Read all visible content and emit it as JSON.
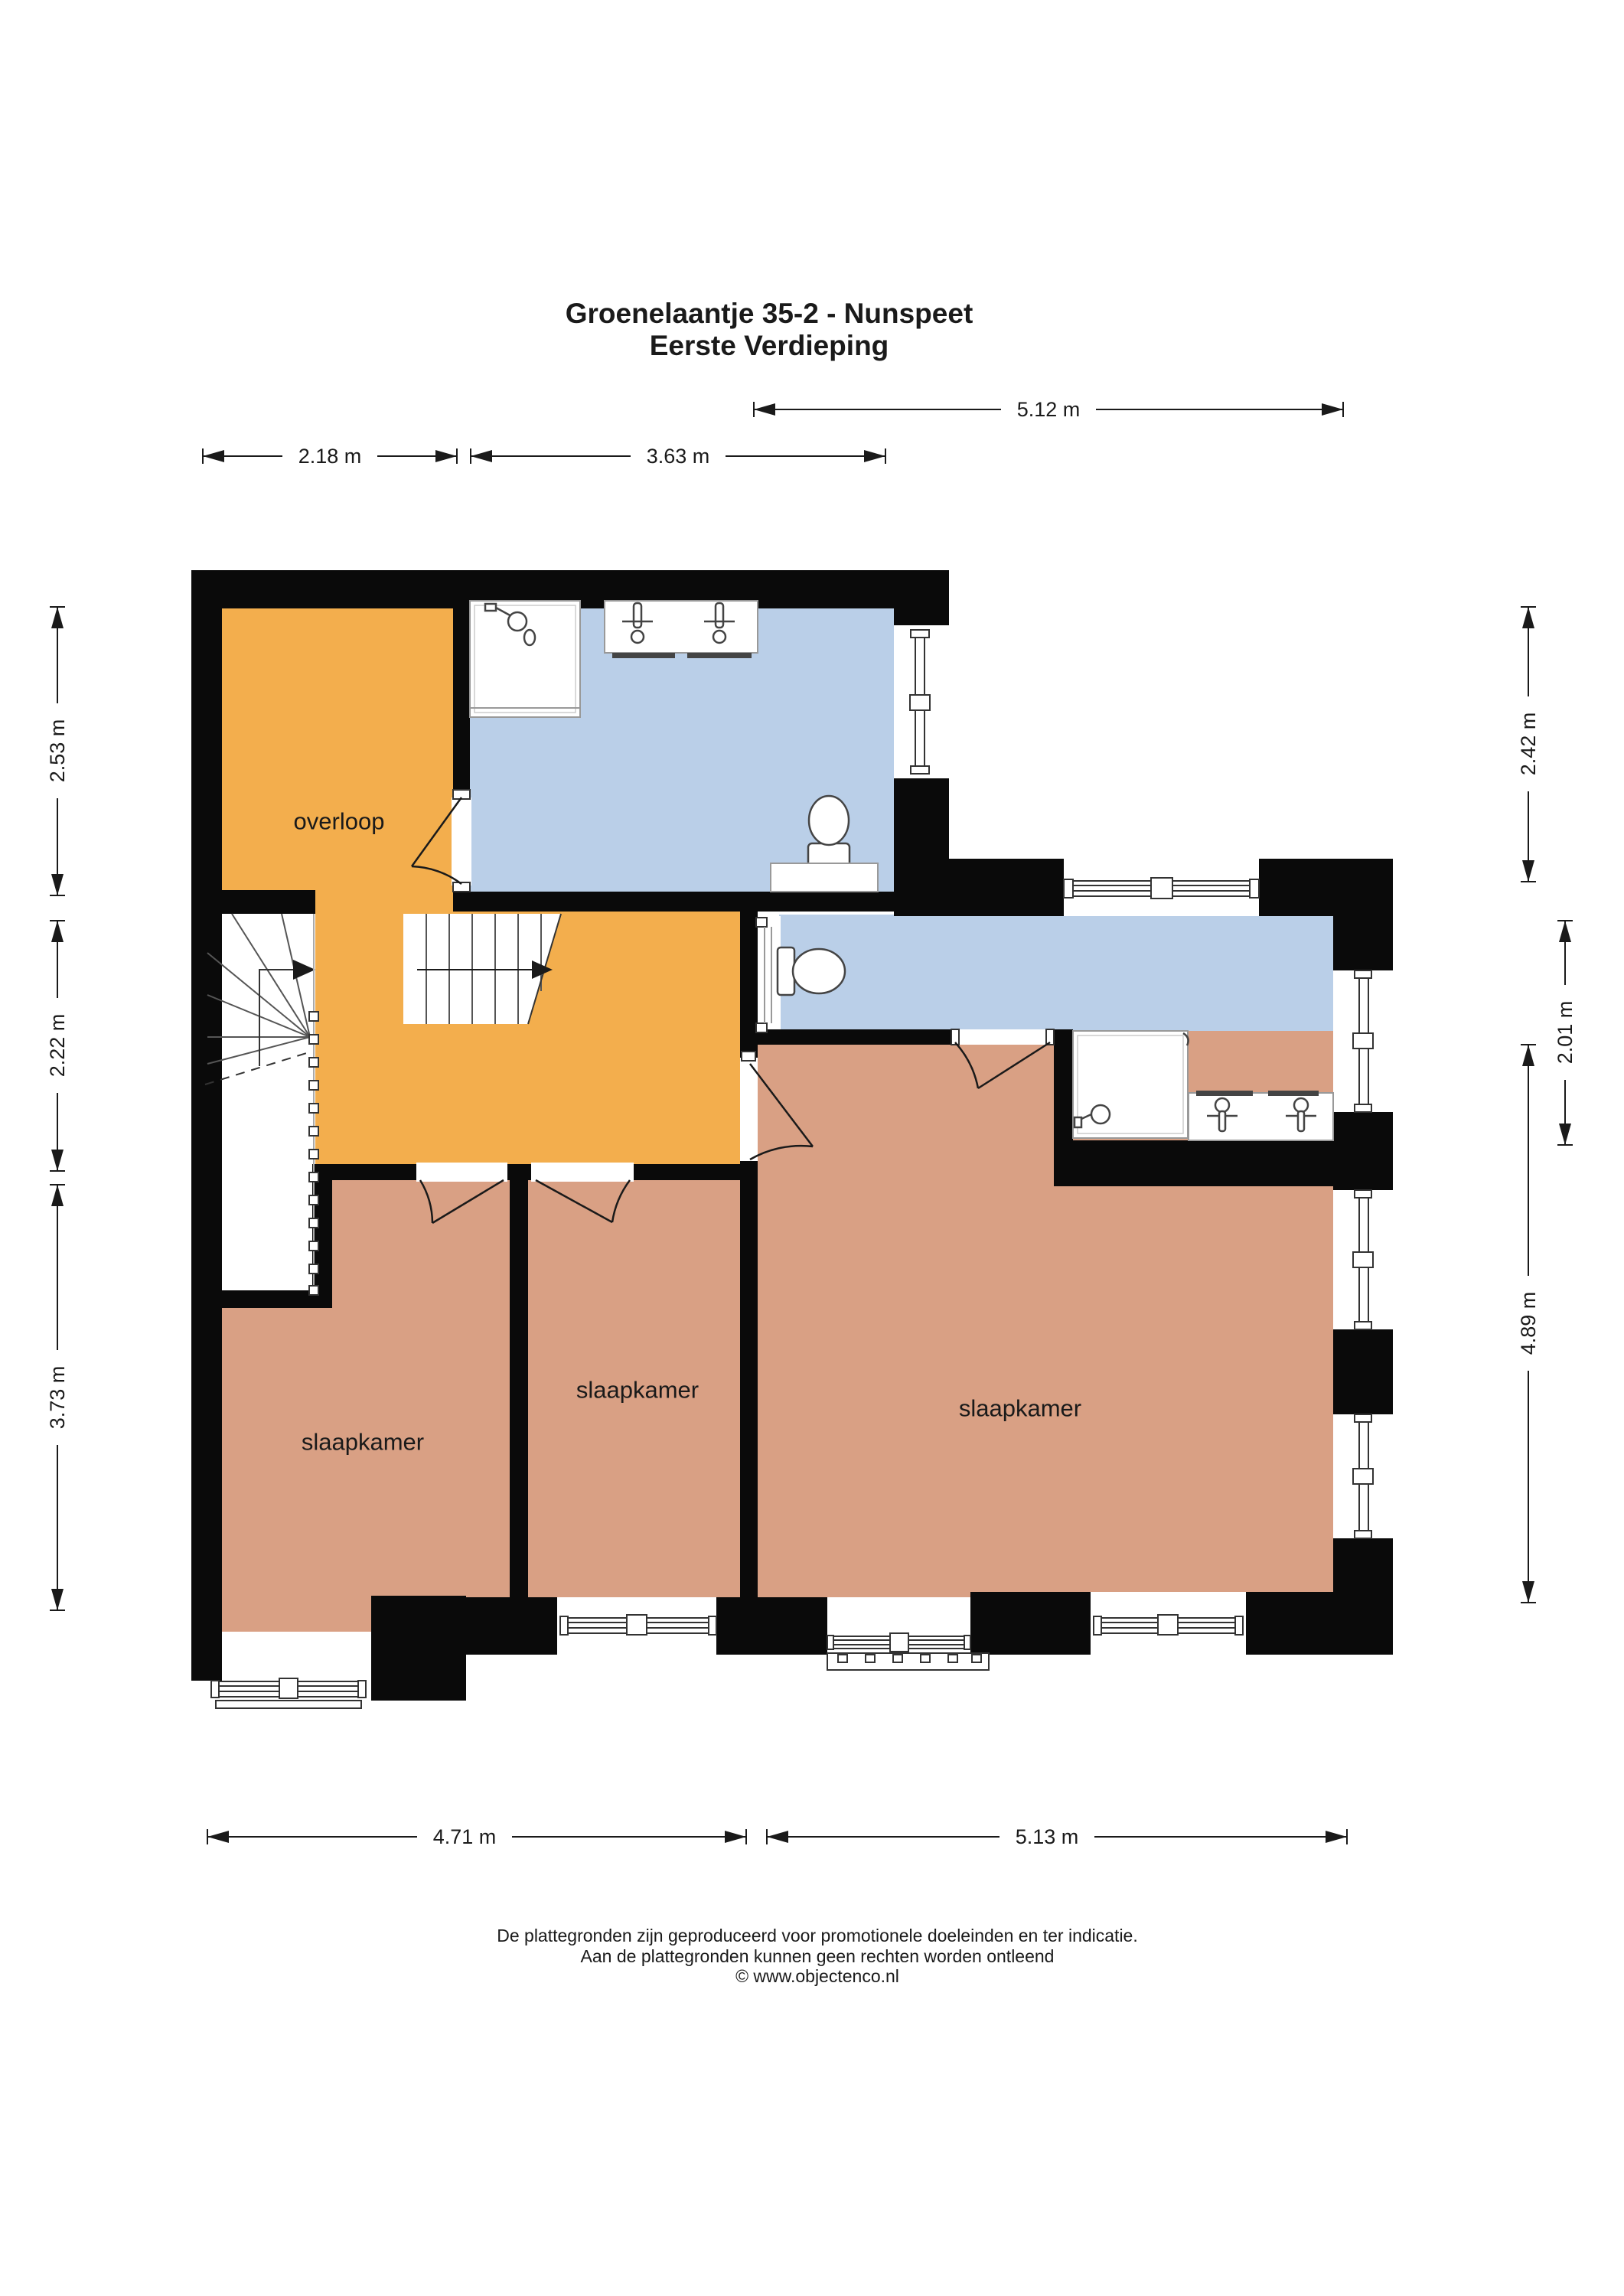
{
  "title": {
    "line1": "Groenelaantje 35-2 - Nunspeet",
    "line2": "Eerste Verdieping"
  },
  "rooms": {
    "overloop": "overloop",
    "bedroom_left": "slaapkamer",
    "bedroom_middle": "slaapkamer",
    "bedroom_right": "slaapkamer"
  },
  "dimensions": {
    "top_right": "5.12 m",
    "top_left": "2.18 m",
    "top_middle": "3.63 m",
    "left_upper": "2.53 m",
    "left_middle": "2.22 m",
    "left_lower": "3.73 m",
    "right_upper": "2.42 m",
    "right_middle": "2.01 m",
    "right_lower": "4.89 m",
    "bottom_left": "4.71 m",
    "bottom_right": "5.13 m"
  },
  "footer": {
    "line1": "De plattegronden zijn geproduceerd voor promotionele doeleinden en ter indicatie.",
    "line2": "Aan de plattegronden kunnen geen rechten worden ontleend",
    "line3": "© www.objectenco.nl"
  },
  "colors": {
    "hallway_orange": "#F3AE4D",
    "bathroom_blue": "#BACFE8",
    "bedroom_salmon": "#D9A084",
    "wall_black": "#0a0a0a"
  }
}
